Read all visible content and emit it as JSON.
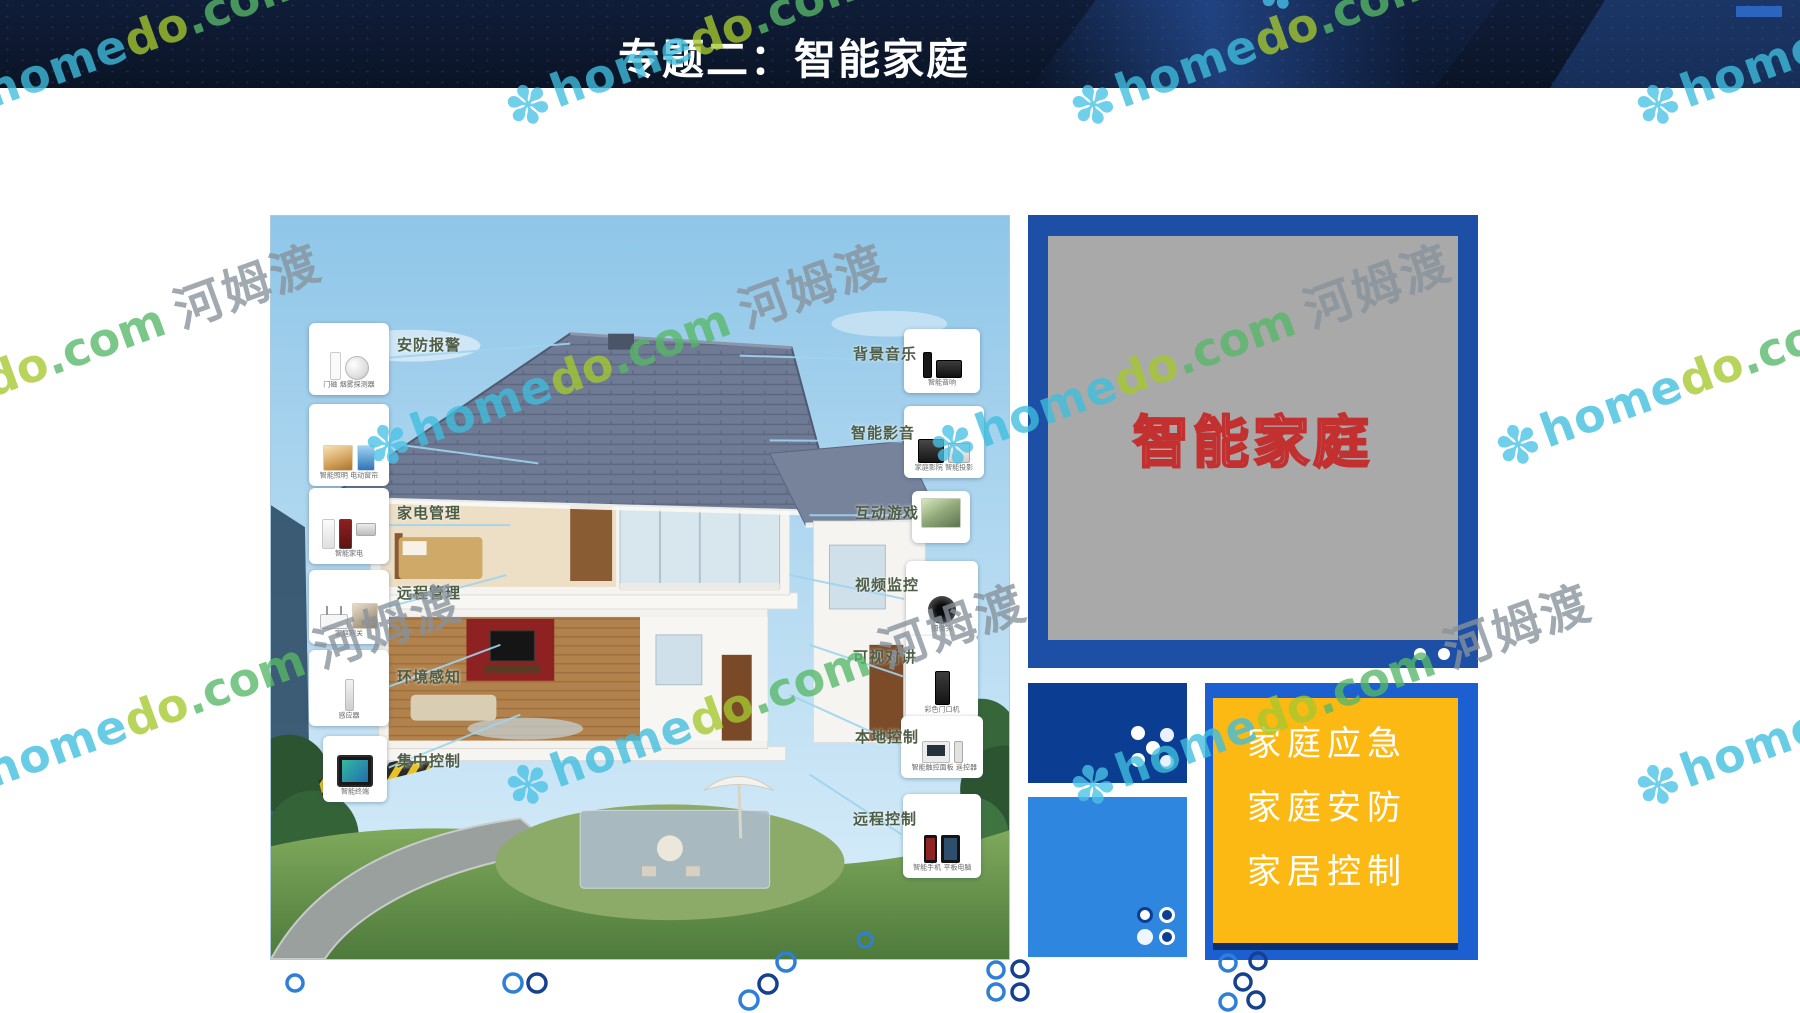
{
  "header": {
    "title": "专题二：智能家庭"
  },
  "watermark": {
    "flower": "✽",
    "word_home": "home",
    "word_do": "do",
    "word_com": ".com",
    "brand_cn": "河姆渡"
  },
  "diagram": {
    "left_items": [
      {
        "label": "安防报警",
        "caption": "门磁 烟雾探测器",
        "icons": [
          "door-sensor",
          "smoke-detector"
        ]
      },
      {
        "label": "",
        "caption": "智能照明 电动窗帘",
        "icons": [
          "scene-warm",
          "scene-blue"
        ]
      },
      {
        "label": "家电管理",
        "caption": "智能家电",
        "icons": [
          "appliance-white",
          "wine-cooler",
          "range-hood"
        ]
      },
      {
        "label": "远程管理",
        "caption": "家庭网关",
        "icons": [
          "router",
          "scene-room"
        ]
      },
      {
        "label": "环境感知",
        "caption": "感应器",
        "icons": [
          "sensor-stick"
        ]
      },
      {
        "label": "集中控制",
        "caption": "智能终端",
        "icons": [
          "touch-terminal"
        ]
      }
    ],
    "right_items": [
      {
        "label": "背景音乐",
        "caption": "智能音响",
        "icons": [
          "speaker",
          "av-receiver"
        ]
      },
      {
        "label": "智能影音",
        "caption": "家庭影院 智能投影",
        "icons": [
          "home-theater",
          "projector"
        ]
      },
      {
        "label": "互动游戏",
        "caption": "",
        "icons": [
          "game-scene"
        ]
      },
      {
        "label": "视频监控",
        "caption": "摄像头",
        "icons": [
          "camera"
        ]
      },
      {
        "label": "可视对讲",
        "caption": "彩色门口机",
        "icons": [
          "door-station"
        ]
      },
      {
        "label": "本地控制",
        "caption": "智能触控面板 遥控器",
        "icons": [
          "control-panel",
          "remote"
        ]
      },
      {
        "label": "远程控制",
        "caption": "智能手机 平板电脑",
        "icons": [
          "smartphone",
          "tablet"
        ]
      }
    ]
  },
  "panel": {
    "headline": "智能家庭",
    "bullets": [
      "家庭应急",
      "家庭安防",
      "家居控制"
    ]
  },
  "colors": {
    "header_bg": "#0c1830",
    "frame_blue": "#1d4fa6",
    "screen_gray": "#a9a9a9",
    "box_dark_blue": "#0b3e93",
    "box_light_blue": "#2e86df",
    "box_yellow": "#fdb913",
    "headline_red": "#c23030",
    "bullet_text": "#ffffff",
    "label_green": "#4e5d45",
    "ring_blue": "#2e7fd8",
    "ring_navy": "#16418f",
    "wm_cyan": "#3fbede",
    "wm_lime": "#a6c82e",
    "wm_green": "#57b868",
    "wm_gray": "#87929c"
  }
}
